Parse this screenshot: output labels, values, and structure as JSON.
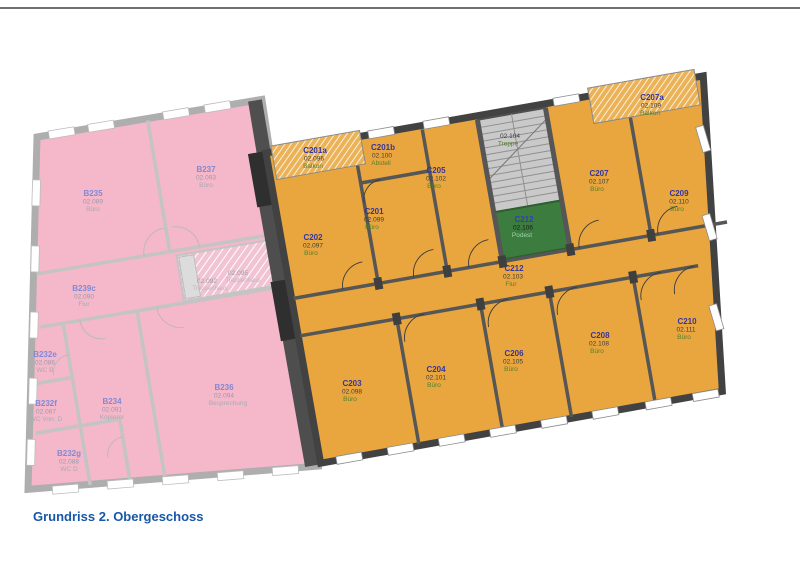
{
  "title": "Grundriss 2. Obergeschoss",
  "colors": {
    "pink_building": "#f5b7ca",
    "orange_building": "#e9a63f",
    "stair_landing_green": "#3c7d3f",
    "stair_gray": "#c9c9c9",
    "title_blue": "#1857a8",
    "room_name_blue": "#34359e",
    "room_type_green": "#527f2a"
  },
  "b_wing": {
    "rooms": [
      {
        "name": "B235",
        "number": "02.089",
        "type": "Büro"
      },
      {
        "name": "B237",
        "number": "02.093",
        "type": "Büro"
      },
      {
        "name": "B239c",
        "number": "02.090",
        "type": "Flur"
      },
      {
        "name": "",
        "number": "02.092",
        "type": "Treppenhaus"
      },
      {
        "name": "",
        "number": "02.095",
        "type": "Treppenhaus"
      },
      {
        "name": "B232e",
        "number": "02.086",
        "type": "WC B"
      },
      {
        "name": "B232f",
        "number": "02.087",
        "type": "WC Vorr. D"
      },
      {
        "name": "B232g",
        "number": "02.088",
        "type": "WC D"
      },
      {
        "name": "B234",
        "number": "02.091",
        "type": "Kopierer"
      },
      {
        "name": "B236",
        "number": "02.094",
        "type": "Besprechung"
      }
    ]
  },
  "c_wing": {
    "rooms": [
      {
        "name": "C201a",
        "number": "02.096",
        "type": "Balkon"
      },
      {
        "name": "C201b",
        "number": "02.100",
        "type": "Abstell"
      },
      {
        "name": "C202",
        "number": "02.097",
        "type": "Büro"
      },
      {
        "name": "C201",
        "number": "02.099",
        "type": "Büro"
      },
      {
        "name": "C205",
        "number": "02.102",
        "type": "Büro"
      },
      {
        "name": "",
        "number": "02.104",
        "type": "Treppe"
      },
      {
        "name": "C212",
        "number": "02.106",
        "type": "Podest"
      },
      {
        "name": "C207",
        "number": "02.107",
        "type": "Büro"
      },
      {
        "name": "C209",
        "number": "02.110",
        "type": "Büro"
      },
      {
        "name": "C207a",
        "number": "02.109",
        "type": "Balkon"
      },
      {
        "name": "C212",
        "number": "02.103",
        "type": "Flur"
      },
      {
        "name": "C203",
        "number": "02.098",
        "type": "Büro"
      },
      {
        "name": "C204",
        "number": "02.101",
        "type": "Büro"
      },
      {
        "name": "C206",
        "number": "02.105",
        "type": "Büro"
      },
      {
        "name": "C208",
        "number": "02.108",
        "type": "Büro"
      },
      {
        "name": "C210",
        "number": "02.111",
        "type": "Büro"
      }
    ]
  }
}
